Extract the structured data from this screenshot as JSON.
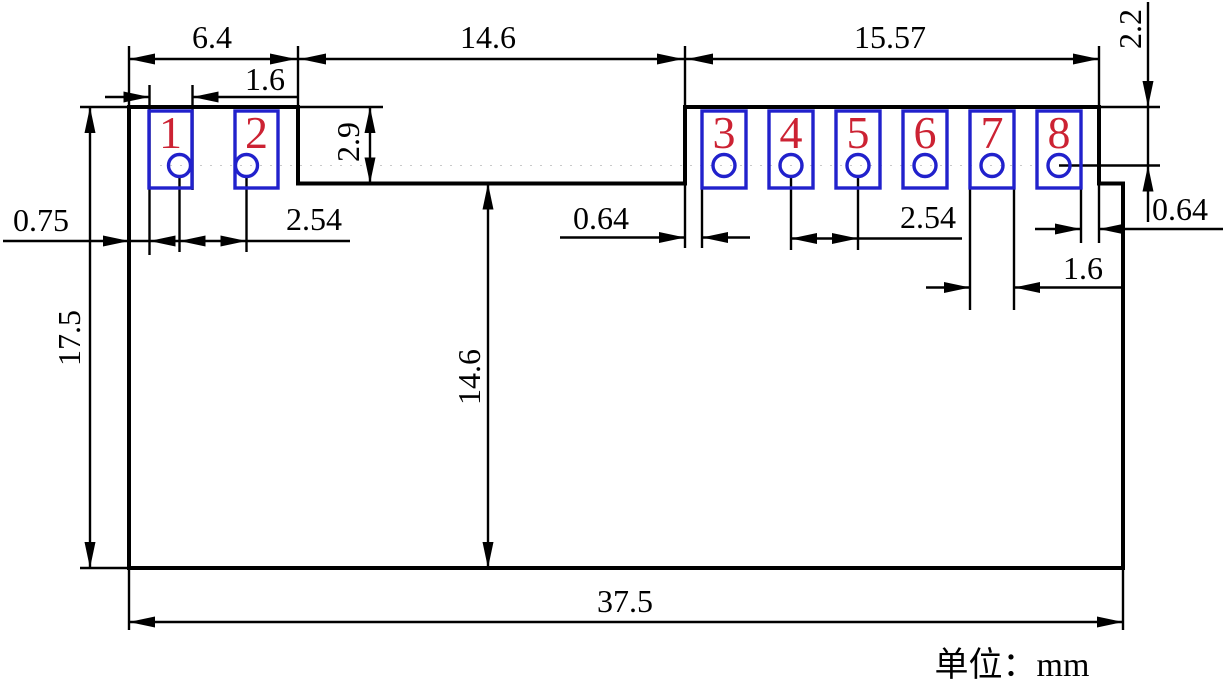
{
  "drawing": {
    "title": "module-footprint-dimension-drawing",
    "unit_note": "单位：mm"
  },
  "colors": {
    "line": "#000000",
    "pad_outline": "#2121cc",
    "pad_number": "#cc2233",
    "background": "#ffffff"
  },
  "pads": [
    {
      "number": "1"
    },
    {
      "number": "2"
    },
    {
      "number": "3"
    },
    {
      "number": "4"
    },
    {
      "number": "5"
    },
    {
      "number": "6"
    },
    {
      "number": "7"
    },
    {
      "number": "8"
    }
  ],
  "dimensions": {
    "top_left_block_width": "6.4",
    "top_middle_gap": "14.6",
    "top_right_block_width": "15.57",
    "left_pad_width": "1.6",
    "pad_height": "2.9",
    "left_edge_to_pad": "0.75",
    "left_pad_pitch": "2.54",
    "left_block_edge_to_pad": "0.64",
    "right_pad_pitch": "2.54",
    "right_block_edge_to_pad": "0.64",
    "right_pad_width": "1.6",
    "top_edge_to_hole": "2.2",
    "board_height": "17.5",
    "notch_depth": "14.6",
    "board_width": "37.5"
  }
}
